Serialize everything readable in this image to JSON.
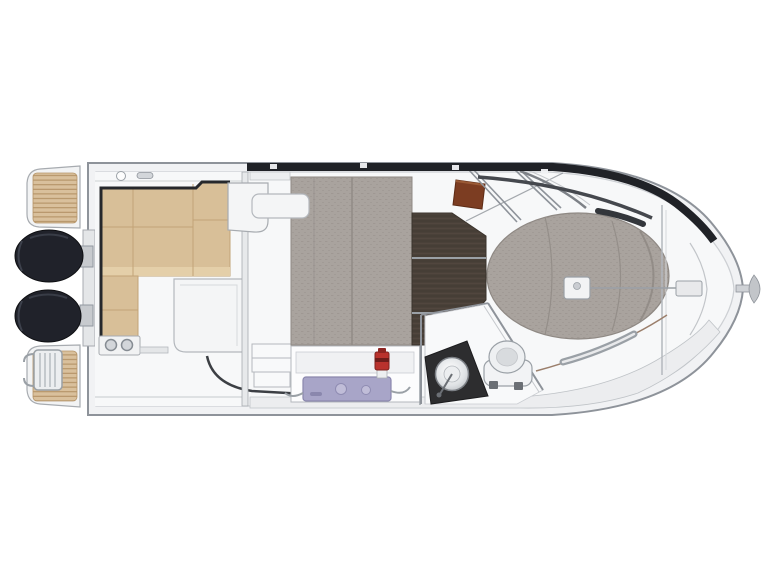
{
  "figure": {
    "type": "boat-deck-plan",
    "orientation": "stern-left-bow-right",
    "visible_text": ""
  },
  "palette": {
    "background": "#ffffff",
    "hull_fill": "#f1f2f4",
    "hull_stroke": "#8e939a",
    "deck_fill": "#f7f8f9",
    "walkway_gray": "#ecedef",
    "teak": "#d9c09c",
    "teak_line": "#b08e61",
    "engine_black": "#20222a",
    "bench_tan": "#d8bf98",
    "bench_seam": "#c2a377",
    "bench_edge": "#26282c",
    "cushion_gray": "#a9a39e",
    "cushion_seam": "#918b86",
    "floor_brown": "#4a4139",
    "helm_seat_brown": "#7c3d22",
    "stove_lavender": "#a8a5c8",
    "stove_line": "#8a87ad",
    "faucet_red": "#b9322d",
    "counter_black": "#2d2d2f",
    "roof_band_dark": "#202227",
    "rail_gray": "#9aa0a6",
    "toe_rail_brown": "#9b7f6c"
  },
  "parts": [
    {
      "id": "swim-platform-port",
      "kind": "teak-platform"
    },
    {
      "id": "swim-platform-starboard",
      "kind": "teak-platform-with-ladder"
    },
    {
      "id": "outboard-engine-port",
      "kind": "engine"
    },
    {
      "id": "outboard-engine-starboard",
      "kind": "engine"
    },
    {
      "id": "cockpit-bench",
      "kind": "l-shaped-seat"
    },
    {
      "id": "cockpit-table-module",
      "kind": "table"
    },
    {
      "id": "wet-bar-cupholders",
      "kind": "fitting"
    },
    {
      "id": "saloon-berth-cushion",
      "kind": "upholstery"
    },
    {
      "id": "wheelhouse-floor",
      "kind": "wood-floor"
    },
    {
      "id": "helm-seat",
      "kind": "seat"
    },
    {
      "id": "galley-stove",
      "kind": "appliance"
    },
    {
      "id": "galley-faucet",
      "kind": "fixture"
    },
    {
      "id": "head-sink",
      "kind": "fixture"
    },
    {
      "id": "head-toilet",
      "kind": "fixture"
    },
    {
      "id": "bow-sunpad",
      "kind": "upholstery"
    },
    {
      "id": "windlass",
      "kind": "fitting"
    },
    {
      "id": "anchor-roller",
      "kind": "fitting"
    },
    {
      "id": "anchor",
      "kind": "fitting"
    }
  ]
}
